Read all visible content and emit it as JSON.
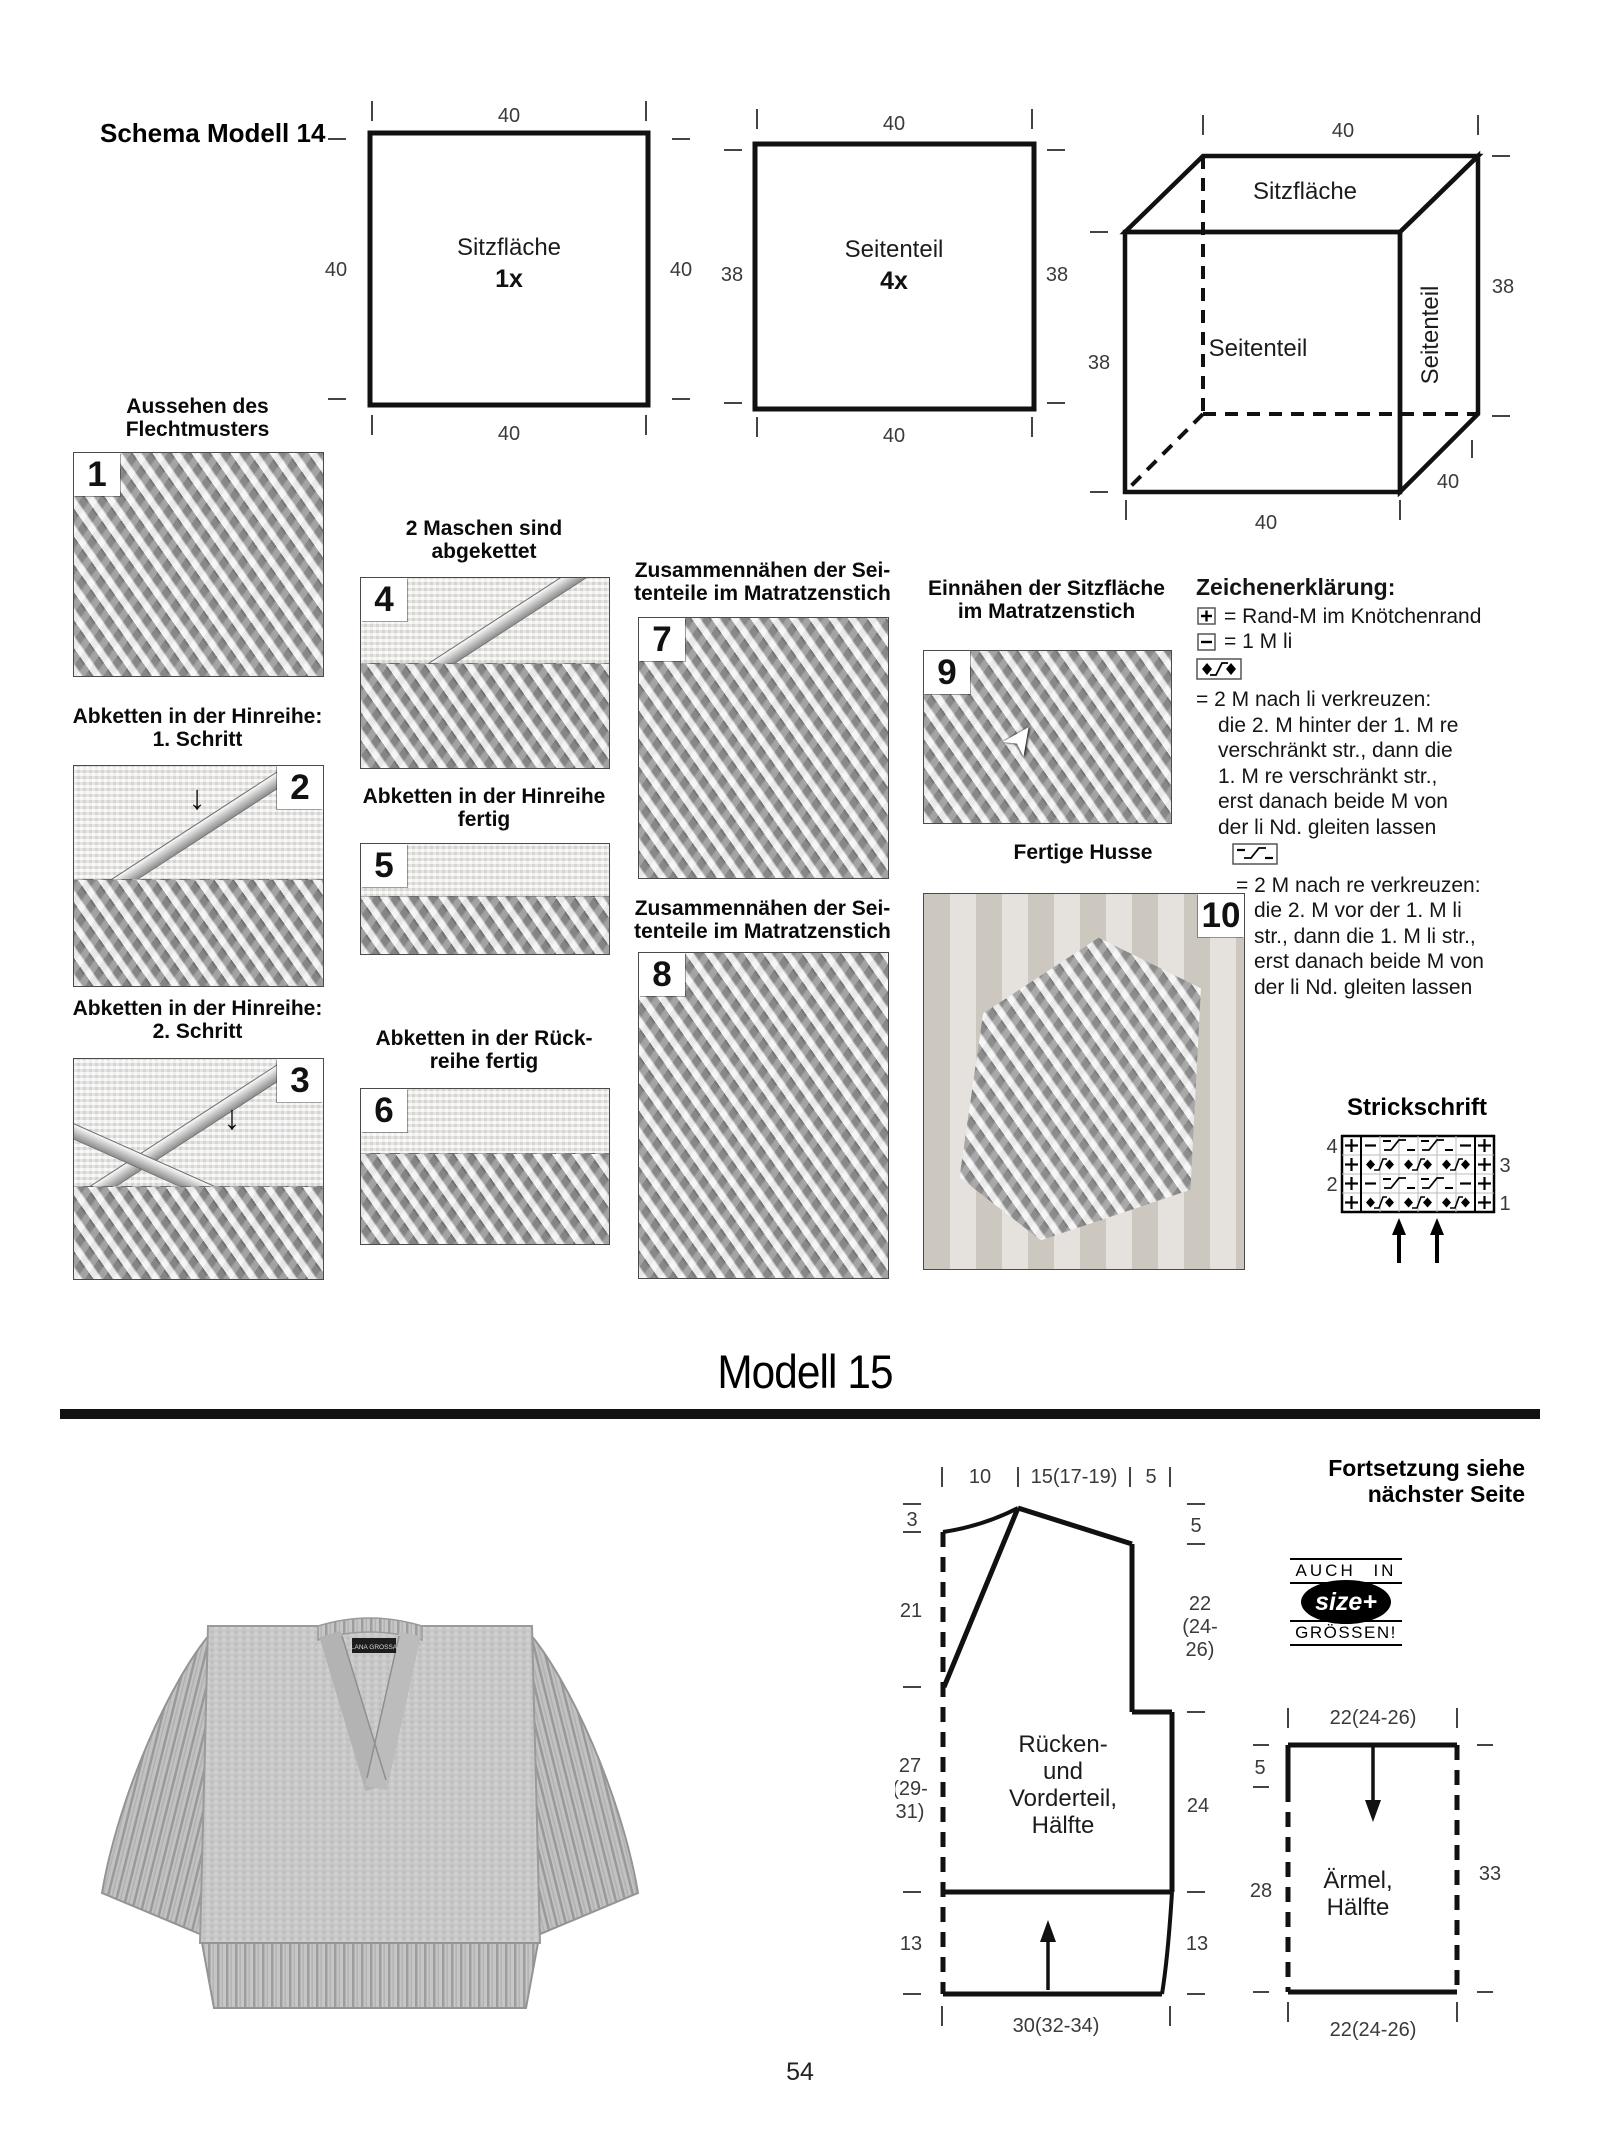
{
  "page_number": "54",
  "schema14": {
    "heading": "Schema Modell 14",
    "pieces": [
      {
        "label": "Sitzfläche",
        "count": "1x",
        "dim_top": "40",
        "dim_bottom": "40",
        "dim_left": "40",
        "dim_right": "40"
      },
      {
        "label": "Seitenteil",
        "count": "4x",
        "dim_top": "40",
        "dim_bottom": "40",
        "dim_left": "38",
        "dim_right": "38"
      }
    ],
    "cube": {
      "top_label": "Sitzfläche",
      "front_label": "Seitenteil",
      "side_label": "Seitenteil",
      "dim_top": "40",
      "dim_right": "38",
      "dim_left": "38",
      "dim_bottom": "40",
      "dim_depth": "40"
    }
  },
  "steps": [
    {
      "num": "1",
      "caption": "Aussehen des\nFlechtmusters"
    },
    {
      "num": "2",
      "caption": "Abketten in der Hinreihe:\n1. Schritt"
    },
    {
      "num": "3",
      "caption": "Abketten in der Hinreihe:\n2. Schritt"
    },
    {
      "num": "4",
      "caption": "2 Maschen sind\nabgekettet"
    },
    {
      "num": "5",
      "caption": "Abketten in der Hinreihe\nfertig"
    },
    {
      "num": "6",
      "caption": "Abketten in der Rück-\nreihe fertig"
    },
    {
      "num": "7",
      "caption": "Zusammennähen der Sei-\ntenteile im Matratzenstich"
    },
    {
      "num": "8",
      "caption": "Zusammennähen der Sei-\ntenteile im Matratzenstich"
    },
    {
      "num": "9",
      "caption": "Einnähen der Sitzfläche\nim Matratzenstich"
    },
    {
      "num": "10",
      "caption": "Fertige Husse"
    }
  ],
  "legend": {
    "title": "Zeichenerklärung:",
    "item1": {
      "symbol": "boxed-plus",
      "text": "= Rand-M im Knötchenrand"
    },
    "item2": {
      "symbol": "boxed-minus",
      "text": "= 1 M li"
    },
    "item3": {
      "symbol": "cross-left-2M",
      "head": "= 2 M nach li verkreuzen:",
      "lines": "die 2. M hinter der 1. M re\nverschränkt str., dann die\n1. M re verschränkt str.,\nerst danach beide M von\nder li Nd. gleiten lassen"
    },
    "item4": {
      "symbol": "cross-right-2M",
      "head": "= 2 M nach re verkreuzen:",
      "lines": "die 2. M vor der 1. M li\nstr., dann die 1. M li str.,\nerst danach beide M von\nder li Nd. gleiten lassen"
    }
  },
  "strickschrift": {
    "title": "Strickschrift",
    "rows_left": [
      "4",
      "2"
    ],
    "rows_right": [
      "3",
      "1"
    ],
    "pattern_rows_top_to_bottom": [
      [
        "+",
        "-",
        "2M-re-cross",
        "2M-re-cross",
        "-",
        "+"
      ],
      [
        "+",
        "2M-li-cross",
        "2M-li-cross",
        "2M-li-cross",
        "+"
      ],
      [
        "+",
        "-",
        "2M-re-cross",
        "2M-re-cross",
        "-",
        "+"
      ],
      [
        "+",
        "2M-li-cross",
        "2M-li-cross",
        "2M-li-cross",
        "+"
      ]
    ],
    "repeat_arrow_count": 2
  },
  "modell15": {
    "title": "Modell 15",
    "continuation": "Fortsetzung siehe\nnächster Seite",
    "badge": {
      "top": "AUCH IN",
      "middle": "size+",
      "bottom": "GRÖSSEN!"
    },
    "sweater_tag": "LANA GROSSA",
    "body": {
      "label_lines": [
        "Rücken-",
        "und",
        "Vorderteil,",
        "Hälfte"
      ],
      "top_dim1": "10",
      "top_dim2": "15(17-19)",
      "top_dim3": "5",
      "left_dim1": "3",
      "left_dim2": "21",
      "left_dim3a": "27",
      "left_dim3b": "(29-",
      "left_dim3c": "31)",
      "left_dim4": "13",
      "right_dim1": "5",
      "right_dim2a": "22",
      "right_dim2b": "(24-",
      "right_dim2c": "26)",
      "right_dim3": "24",
      "right_dim4": "13",
      "bottom_dim": "30(32-34)"
    },
    "sleeve": {
      "label_lines": [
        "Ärmel,",
        "Hälfte"
      ],
      "top_dim": "22(24-26)",
      "bottom_dim": "22(24-26)",
      "left_dim1": "5",
      "left_dim2": "28",
      "right_dim": "33"
    }
  }
}
